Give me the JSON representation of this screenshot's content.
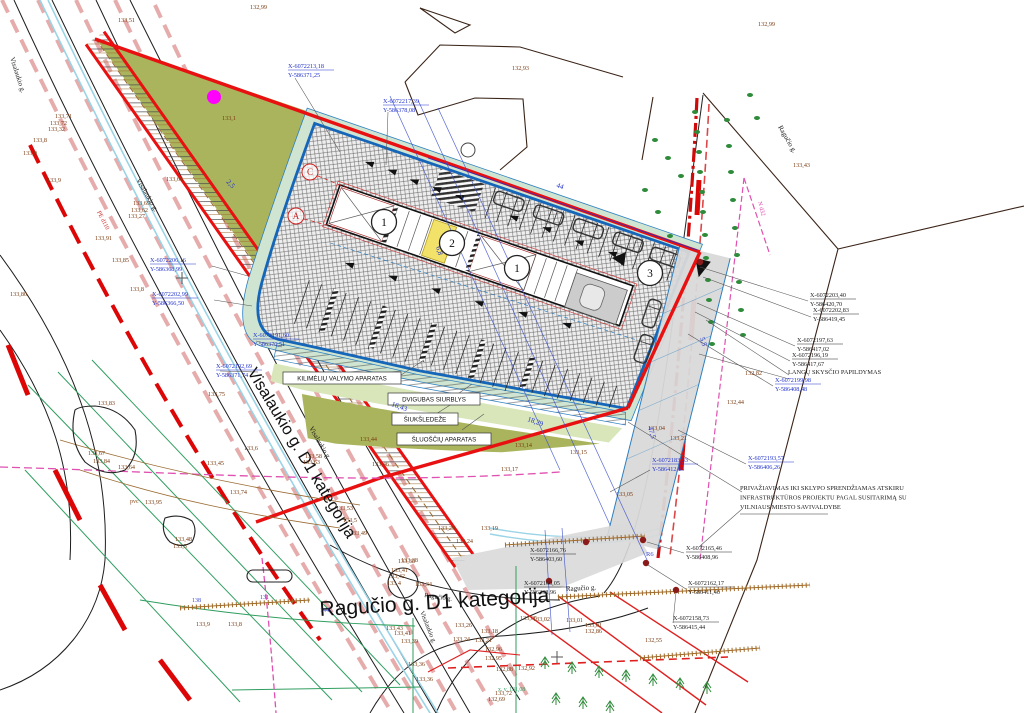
{
  "palette": {
    "site_boundary_red": "#e81010",
    "parcel_blue": "#1566b8",
    "dimension_blue": "#2233cc",
    "coordinate_blue": "#2233cc",
    "coordinate_black": "#222222",
    "elevation_brown": "#7a3b12",
    "greenery_olive": "#a9b45c",
    "greenery_mint": "#cfe5d2",
    "band_green": "#d8e6ba",
    "utility_green": "#2f9e5f",
    "utility_magenta": "#e050b0",
    "utility_cyan": "#9ad4e6",
    "road_pink": "#d26a6a",
    "bright_red": "#dc0606",
    "tan_brown": "#a06a28",
    "yellow_unit": "#f2e26a",
    "gray_paving": "#d9d9d9"
  },
  "street_labels": {
    "visalaukio_main": "Visalaukio g. D1 kategorija",
    "ragucio_main": "Ragučio g. D1 kategorija"
  },
  "streets": [
    {
      "t": "Visalaukio g.",
      "x": 10,
      "y": 58,
      "r": 72,
      "f": 7
    },
    {
      "t": "Visalaukio g.",
      "x": 136,
      "y": 180,
      "r": 60,
      "f": 7
    },
    {
      "t": "Visalaukio g.",
      "x": 309,
      "y": 428,
      "r": 60,
      "f": 7
    },
    {
      "t": "Visalaukio g.",
      "x": 420,
      "y": 612,
      "r": 68,
      "f": 6.5
    },
    {
      "t": "Ragučio g.",
      "x": 778,
      "y": 127,
      "r": 60,
      "f": 7
    },
    {
      "t": "Ragučio g.",
      "x": 424,
      "y": 597,
      "r": 8,
      "f": 6.5
    },
    {
      "t": "Ragučio g.",
      "x": 566,
      "y": 591,
      "r": -3,
      "f": 7
    }
  ],
  "equipment_callouts": [
    "KILIMĖLIŲ VALYMO APARATAS",
    "DVIGUBAS SIURBLYS",
    "ŠIUKŠLEDEŽE",
    "ŠLUOŠČIŲ APARATAS"
  ],
  "notes": {
    "langu_skyscio": "LANGŲ SKYSČIO PAPILDYMAS",
    "privaziavimas": [
      "PRIVAŽIAVIMAS IKI SKLYPO SPRENDŽIAMAS ATSKIRU",
      "INFRASTRUKTŪROS PROJEKTU PAGAL SUSITARIMĄ SU",
      "VILNIAUS MIESTO SAVIVALDYBE"
    ]
  },
  "section_markers": [
    {
      "t": "1",
      "x": 384,
      "y": 222
    },
    {
      "t": "2",
      "x": 452,
      "y": 243
    },
    {
      "t": "1",
      "x": 517,
      "y": 268
    },
    {
      "t": "3",
      "x": 650,
      "y": 273
    }
  ],
  "grid_letters": [
    {
      "t": "C",
      "x": 310,
      "y": 172
    },
    {
      "t": "A",
      "x": 296,
      "y": 216
    }
  ],
  "dims": [
    {
      "t": "44",
      "x": 556,
      "y": 187,
      "r": 19
    },
    {
      "t": "18,29",
      "x": 527,
      "y": 421,
      "r": 19
    },
    {
      "t": "16,43",
      "x": 391,
      "y": 406,
      "r": 19
    },
    {
      "t": "47,5",
      "x": 648,
      "y": 427,
      "r": 74
    },
    {
      "t": "5,5",
      "x": 700,
      "y": 338,
      "r": 74
    },
    {
      "t": "6,8",
      "x": 436,
      "y": 247,
      "r": 74
    },
    {
      "t": "2,5",
      "x": 226,
      "y": 182,
      "r": 48
    }
  ],
  "coordinates": [
    {
      "xv": "X-6072213,18",
      "yv": "Y-586371,25",
      "x": 288,
      "y": 68,
      "c": "blue"
    },
    {
      "xv": "X-6072217,39",
      "yv": "Y-586378,08",
      "x": 383,
      "y": 103,
      "c": "blue"
    },
    {
      "xv": "X-6072206,16",
      "yv": "Y-586368,99",
      "x": 150,
      "y": 262,
      "c": "blue"
    },
    {
      "xv": "X-6072202,99",
      "yv": "Y-586366,50",
      "x": 152,
      "y": 296,
      "c": "blue"
    },
    {
      "xv": "X-6072191,60",
      "yv": "Y-586370,51",
      "x": 253,
      "y": 337,
      "c": "blue"
    },
    {
      "xv": "X-6072192,69",
      "yv": "Y-586371,74",
      "x": 216,
      "y": 368,
      "c": "blue"
    },
    {
      "xv": "X-6072199,98",
      "yv": "Y-586408,48",
      "x": 775,
      "y": 382,
      "c": "blue"
    },
    {
      "xv": "X-6072193,57",
      "yv": "Y-586406,26",
      "x": 748,
      "y": 460,
      "c": "blue"
    },
    {
      "xv": "X-6072183,33",
      "yv": "Y-586412,63",
      "x": 652,
      "y": 462,
      "c": "blue"
    },
    {
      "xv": "X-6072203,40",
      "yv": "Y-586420,70",
      "x": 810,
      "y": 297,
      "c": "black"
    },
    {
      "xv": "X-6072202,83",
      "yv": "Y-586419,45",
      "x": 813,
      "y": 312,
      "c": "black"
    },
    {
      "xv": "X-6072197,63",
      "yv": "Y-586417,02",
      "x": 797,
      "y": 342,
      "c": "black"
    },
    {
      "xv": "X-6072196,19",
      "yv": "Y-586417,67",
      "x": 792,
      "y": 357,
      "c": "black"
    },
    {
      "xv": "X-6072165,46",
      "yv": "Y-586408,96",
      "x": 686,
      "y": 550,
      "c": "black"
    },
    {
      "xv": "X-6072162,17",
      "yv": "Y-586411,40",
      "x": 688,
      "y": 585,
      "c": "black"
    },
    {
      "xv": "X-6072158,73",
      "yv": "Y-586415,44",
      "x": 673,
      "y": 620,
      "c": "black"
    },
    {
      "xv": "X-6072166,76",
      "yv": "Y-586403,60",
      "x": 530,
      "y": 552,
      "c": "black"
    },
    {
      "xv": "X-6072160,05",
      "yv": "Y-586398,96",
      "x": 524,
      "y": 585,
      "c": "black"
    }
  ],
  "elevations": [
    {
      "t": "133,51",
      "x": 118,
      "y": 22
    },
    {
      "t": "132,99",
      "x": 250,
      "y": 9
    },
    {
      "t": "132,93",
      "x": 512,
      "y": 70
    },
    {
      "t": "132,99",
      "x": 758,
      "y": 26
    },
    {
      "t": "133,1",
      "x": 222,
      "y": 120
    },
    {
      "t": "133,71",
      "x": 55,
      "y": 118
    },
    {
      "t": "133,72",
      "x": 50,
      "y": 125
    },
    {
      "t": "133,32",
      "x": 48,
      "y": 131
    },
    {
      "t": "133,8",
      "x": 33,
      "y": 142
    },
    {
      "t": "133,9",
      "x": 23,
      "y": 155
    },
    {
      "t": "133,9",
      "x": 47,
      "y": 182
    },
    {
      "t": "133,66",
      "x": 166,
      "y": 181
    },
    {
      "t": "133,69",
      "x": 133,
      "y": 205
    },
    {
      "t": "133,62",
      "x": 131,
      "y": 212
    },
    {
      "t": "133,27",
      "x": 128,
      "y": 218
    },
    {
      "t": "133,91",
      "x": 95,
      "y": 240
    },
    {
      "t": "133,85",
      "x": 112,
      "y": 262
    },
    {
      "t": "133,8",
      "x": 130,
      "y": 291
    },
    {
      "t": "133,80",
      "x": 10,
      "y": 296
    },
    {
      "t": "133,83",
      "x": 98,
      "y": 405
    },
    {
      "t": "133,67",
      "x": 88,
      "y": 455
    },
    {
      "t": "133,84",
      "x": 93,
      "y": 463
    },
    {
      "t": "133,64",
      "x": 118,
      "y": 469
    },
    {
      "t": "133,75",
      "x": 208,
      "y": 396
    },
    {
      "t": "133,6",
      "x": 244,
      "y": 450
    },
    {
      "t": "133,45",
      "x": 207,
      "y": 465
    },
    {
      "t": "133,74",
      "x": 230,
      "y": 494
    },
    {
      "t": "133,95",
      "x": 145,
      "y": 504
    },
    {
      "t": "133,48",
      "x": 175,
      "y": 541
    },
    {
      "t": "133,3",
      "x": 173,
      "y": 548
    },
    {
      "t": "133,9",
      "x": 196,
      "y": 626
    },
    {
      "t": "133,8",
      "x": 228,
      "y": 626
    },
    {
      "t": "133,44",
      "x": 360,
      "y": 441
    },
    {
      "t": "133,58",
      "x": 305,
      "y": 458
    },
    {
      "t": "133,63",
      "x": 303,
      "y": 464
    },
    {
      "t": "133,46",
      "x": 372,
      "y": 466
    },
    {
      "t": "133,53",
      "x": 336,
      "y": 510
    },
    {
      "t": "133,5",
      "x": 343,
      "y": 522
    },
    {
      "t": "133,49",
      "x": 350,
      "y": 535
    },
    {
      "t": "133,38",
      "x": 401,
      "y": 562
    },
    {
      "t": "133,29",
      "x": 438,
      "y": 530
    },
    {
      "t": "133,24",
      "x": 456,
      "y": 543
    },
    {
      "t": "133,19",
      "x": 481,
      "y": 530
    },
    {
      "t": "133,14",
      "x": 515,
      "y": 447
    },
    {
      "t": "133,15",
      "x": 570,
      "y": 454
    },
    {
      "t": "133,17",
      "x": 501,
      "y": 471
    },
    {
      "t": "133,38",
      "x": 398,
      "y": 563
    },
    {
      "t": "133,41",
      "x": 391,
      "y": 572
    },
    {
      "t": "133,42",
      "x": 388,
      "y": 578
    },
    {
      "t": "133,4",
      "x": 387,
      "y": 585
    },
    {
      "t": "133,34",
      "x": 415,
      "y": 586
    },
    {
      "t": "133,43",
      "x": 386,
      "y": 630
    },
    {
      "t": "133,41",
      "x": 394,
      "y": 635
    },
    {
      "t": "133,39",
      "x": 401,
      "y": 643
    },
    {
      "t": "133,36",
      "x": 408,
      "y": 666
    },
    {
      "t": "133,36",
      "x": 416,
      "y": 681
    },
    {
      "t": "133,26",
      "x": 455,
      "y": 627
    },
    {
      "t": "133,24",
      "x": 453,
      "y": 641
    },
    {
      "t": "133,21",
      "x": 475,
      "y": 642
    },
    {
      "t": "133,18",
      "x": 481,
      "y": 633
    },
    {
      "t": "132,96",
      "x": 485,
      "y": 651
    },
    {
      "t": "132,95",
      "x": 485,
      "y": 660
    },
    {
      "t": "132,88",
      "x": 496,
      "y": 671
    },
    {
      "t": "132,92",
      "x": 518,
      "y": 670
    },
    {
      "t": "132,86",
      "x": 585,
      "y": 633
    },
    {
      "t": "132,55",
      "x": 645,
      "y": 642
    },
    {
      "t": "133,72",
      "x": 495,
      "y": 695
    },
    {
      "t": "132,69",
      "x": 488,
      "y": 701
    },
    {
      "t": "133,05",
      "x": 520,
      "y": 620
    },
    {
      "t": "133,02",
      "x": 533,
      "y": 621
    },
    {
      "t": "133,01",
      "x": 566,
      "y": 622
    },
    {
      "t": "133,01",
      "x": 585,
      "y": 627
    },
    {
      "t": "133,43",
      "x": 793,
      "y": 167
    },
    {
      "t": "132,82",
      "x": 745,
      "y": 375
    },
    {
      "t": "132,44",
      "x": 727,
      "y": 404
    },
    {
      "t": "133,04",
      "x": 648,
      "y": 430
    },
    {
      "t": "133,21",
      "x": 670,
      "y": 440
    },
    {
      "t": "133,05",
      "x": 616,
      "y": 496
    }
  ],
  "utilities": [
    {
      "t": "pvc",
      "x": 130,
      "y": 503,
      "r": 0,
      "f": 6,
      "c": "#8a4a1e"
    },
    {
      "t": "PE d110",
      "x": 97,
      "y": 212,
      "r": 63,
      "f": 6,
      "c": "#cc2222"
    },
    {
      "t": "N d32",
      "x": 758,
      "y": 202,
      "r": 75,
      "f": 6,
      "c": "#dd44aa"
    },
    {
      "t": "x. v. 131,08",
      "x": 498,
      "y": 691,
      "r": 0,
      "f": 5.8,
      "c": "#2e9e5f"
    },
    {
      "t": "138",
      "x": 192,
      "y": 602,
      "r": 0,
      "f": 6,
      "c": "#3344cc"
    },
    {
      "t": "131",
      "x": 260,
      "y": 599,
      "r": 0,
      "f": 6,
      "c": "#3344cc"
    },
    {
      "t": "144",
      "x": 320,
      "y": 612,
      "r": 0,
      "f": 6,
      "c": "#3344cc"
    },
    {
      "t": "R6",
      "x": 646,
      "y": 556,
      "r": 0,
      "f": 6.5,
      "c": "#3344cc"
    }
  ]
}
